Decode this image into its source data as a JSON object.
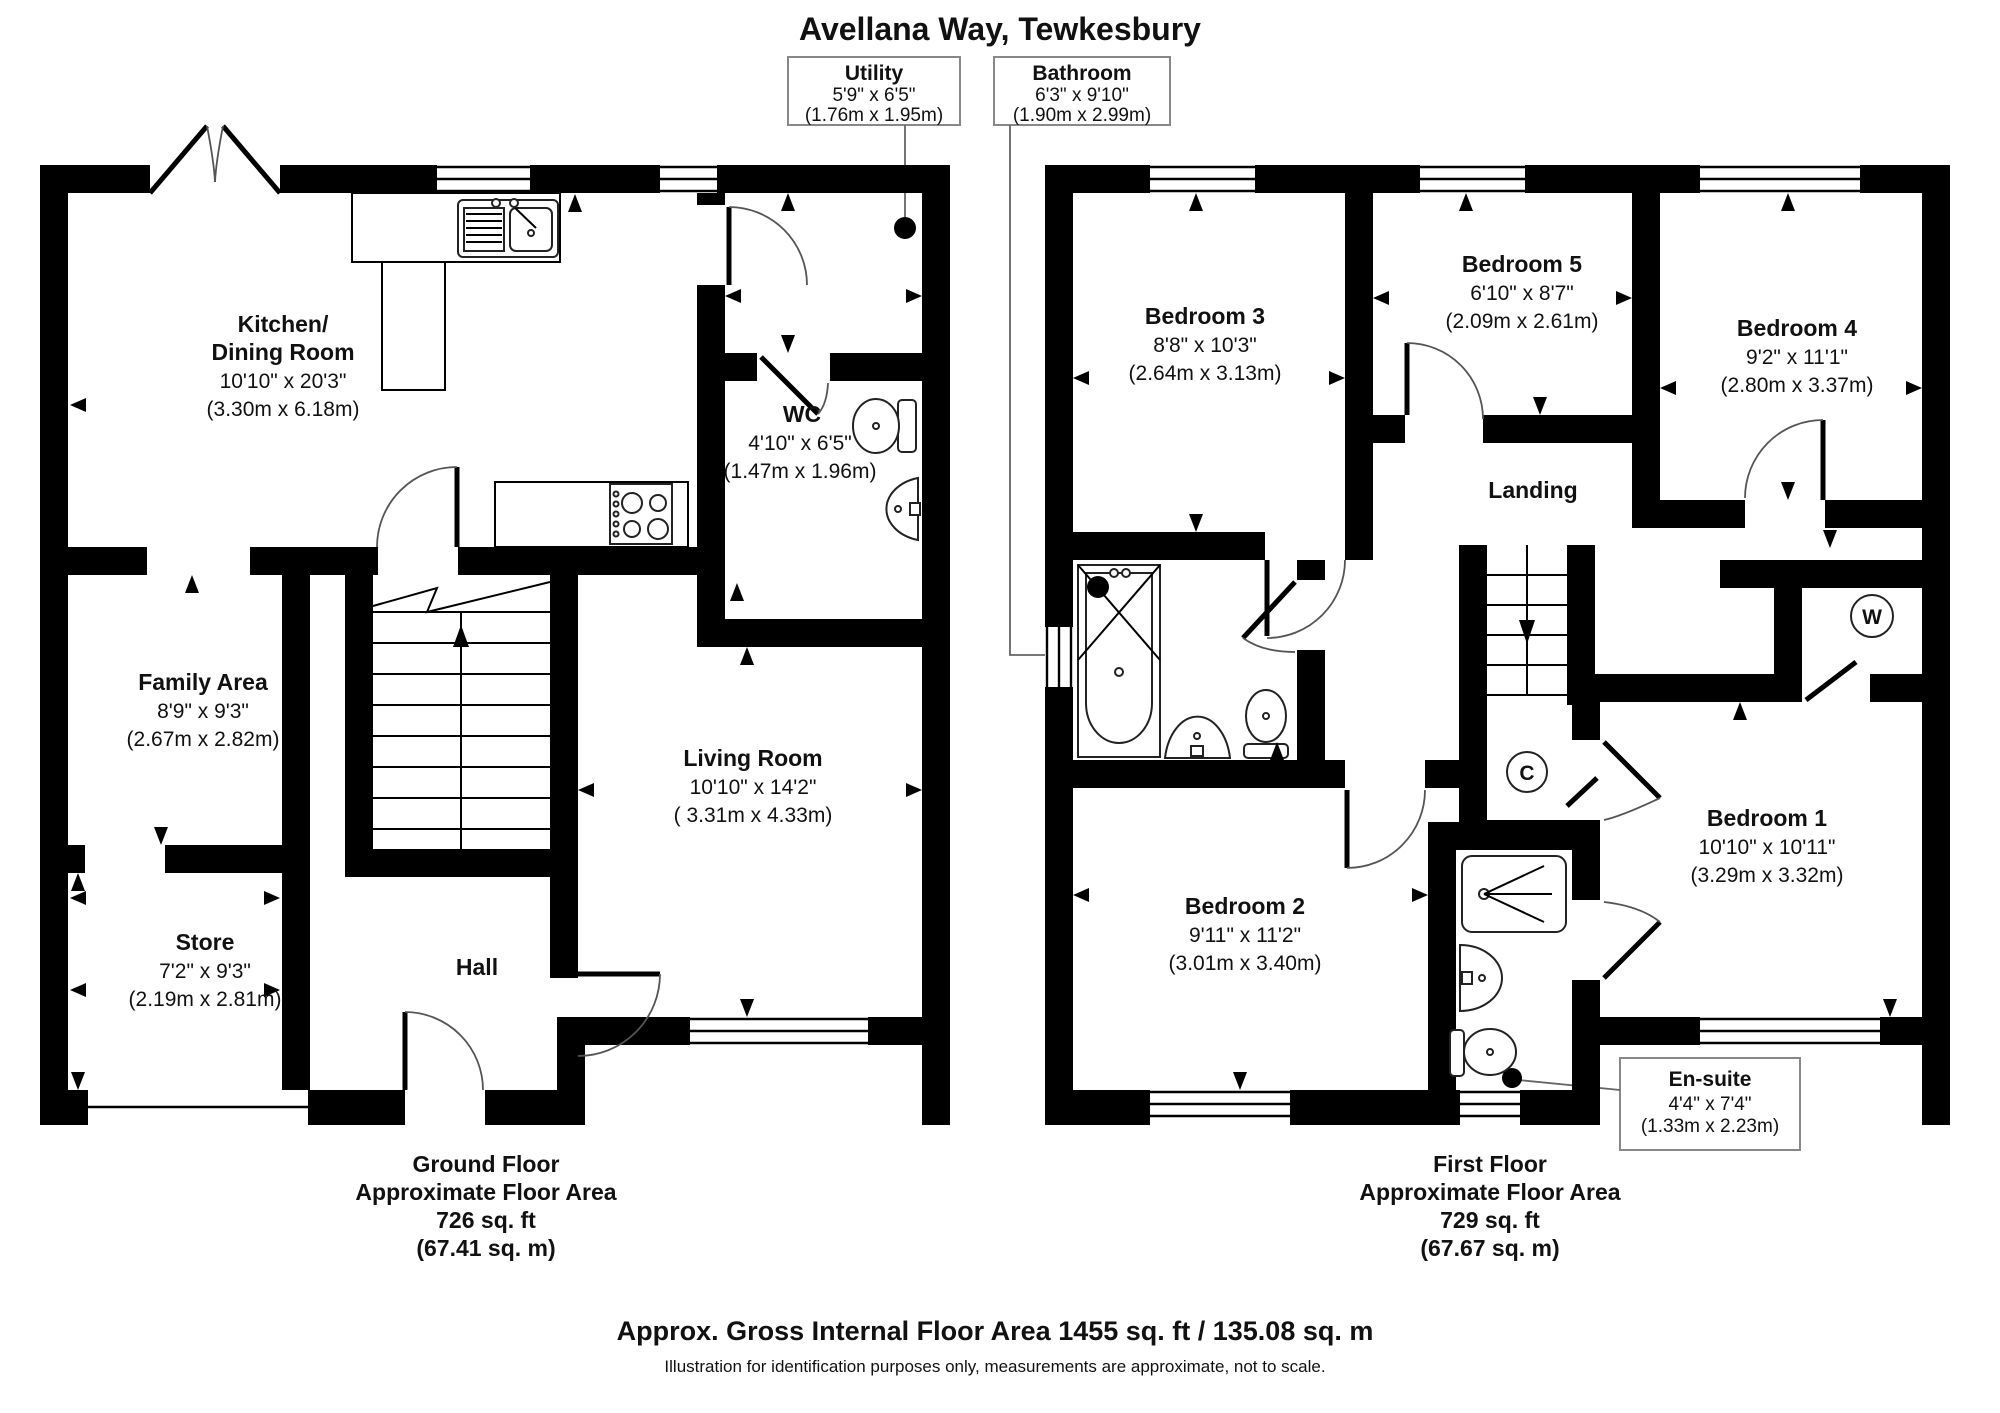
{
  "title": "Avellana Way, Tewkesbury",
  "callouts": {
    "utility": {
      "name": "Utility",
      "imperial": "5'9\" x 6'5\"",
      "metric": "(1.76m x 1.95m)"
    },
    "bathroom": {
      "name": "Bathroom",
      "imperial": "6'3\" x 9'10\"",
      "metric": "(1.90m x 2.99m)"
    },
    "ensuite": {
      "name": "En-suite",
      "imperial": "4'4\" x 7'4\"",
      "metric": "(1.33m x 2.23m)"
    }
  },
  "ground_floor": {
    "rooms": {
      "kitchen": {
        "name": "Kitchen/",
        "name2": "Dining Room",
        "imperial": "10'10\" x 20'3\"",
        "metric": "(3.30m x 6.18m)"
      },
      "wc": {
        "name": "WC",
        "imperial": "4'10\" x 6'5\"",
        "metric": "(1.47m x 1.96m)"
      },
      "family": {
        "name": "Family Area",
        "imperial": "8'9\" x 9'3\"",
        "metric": "(2.67m x 2.82m)"
      },
      "store": {
        "name": "Store",
        "imperial": "7'2\" x 9'3\"",
        "metric": "(2.19m x 2.81m)"
      },
      "living": {
        "name": "Living Room",
        "imperial": "10'10\" x 14'2\"",
        "metric": "( 3.31m x 4.33m)"
      },
      "hall": {
        "name": "Hall"
      }
    },
    "caption": {
      "line1": "Ground Floor",
      "line2": "Approximate Floor Area",
      "line3": "726 sq. ft",
      "line4": "(67.41 sq. m)"
    }
  },
  "first_floor": {
    "rooms": {
      "bedroom1": {
        "name": "Bedroom 1",
        "imperial": "10'10\" x 10'11\"",
        "metric": "(3.29m x 3.32m)"
      },
      "bedroom2": {
        "name": "Bedroom 2",
        "imperial": "9'11\" x 11'2\"",
        "metric": "(3.01m x 3.40m)"
      },
      "bedroom3": {
        "name": "Bedroom 3",
        "imperial": "8'8\" x 10'3\"",
        "metric": "(2.64m x 3.13m)"
      },
      "bedroom4": {
        "name": "Bedroom 4",
        "imperial": "9'2\" x 11'1\"",
        "metric": "(2.80m x 3.37m)"
      },
      "bedroom5": {
        "name": "Bedroom 5",
        "imperial": "6'10\" x 8'7\"",
        "metric": "(2.09m x 2.61m)"
      },
      "landing": {
        "name": "Landing"
      },
      "wardrobe": {
        "abbr": "W"
      },
      "cupboard": {
        "abbr": "C"
      }
    },
    "caption": {
      "line1": "First Floor",
      "line2": "Approximate Floor Area",
      "line3": "729 sq. ft",
      "line4": "(67.67 sq. m)"
    }
  },
  "footer": {
    "line1": "Approx. Gross Internal Floor Area 1455 sq. ft / 135.08 sq. m",
    "line2": "Illustration for identification purposes only, measurements are approximate, not to scale."
  }
}
